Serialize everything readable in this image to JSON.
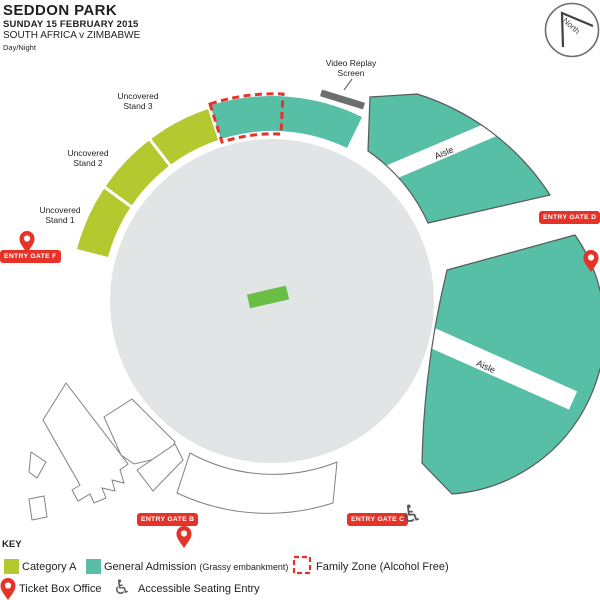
{
  "header": {
    "title": "SEDDON PARK",
    "date": "SUNDAY 15 FEBRUARY 2015",
    "fixture": "SOUTH AFRICA v ZIMBABWE",
    "session": "Day/Night"
  },
  "compass": {
    "label": "North"
  },
  "map": {
    "aisle_label": "Aisle",
    "stands": [
      {
        "line1": "Uncovered",
        "line2": "Stand 3"
      },
      {
        "line1": "Uncovered",
        "line2": "Stand 2"
      },
      {
        "line1": "Uncovered",
        "line2": "Stand 1"
      }
    ],
    "video_screen": {
      "line1": "Video Replay",
      "line2": "Screen"
    },
    "gates": {
      "f": "ENTRY GATE F",
      "b": "ENTRY GATE B",
      "c": "ENTRY GATE C",
      "d": "ENTRY GATE D"
    }
  },
  "key": {
    "title": "KEY",
    "category_a": "Category A",
    "general_admission": "General Admission",
    "general_admission_note": "(Grassy embankment)",
    "family_zone": "Family Zone (Alcohol Free)",
    "ticket_box_office": "Ticket Box Office",
    "accessible": "Accessible Seating Entry"
  },
  "icons": {
    "wheelchair": "♿"
  },
  "colors": {
    "category_a": "#B4C930",
    "general_admission": "#57BFA6",
    "field": "#E2E5E6",
    "pitch": "#6ABE45",
    "red": "#E5332A",
    "screen_bar": "#6D6E70",
    "wedge_outline": "#58595B",
    "building_outline": "#808285"
  }
}
